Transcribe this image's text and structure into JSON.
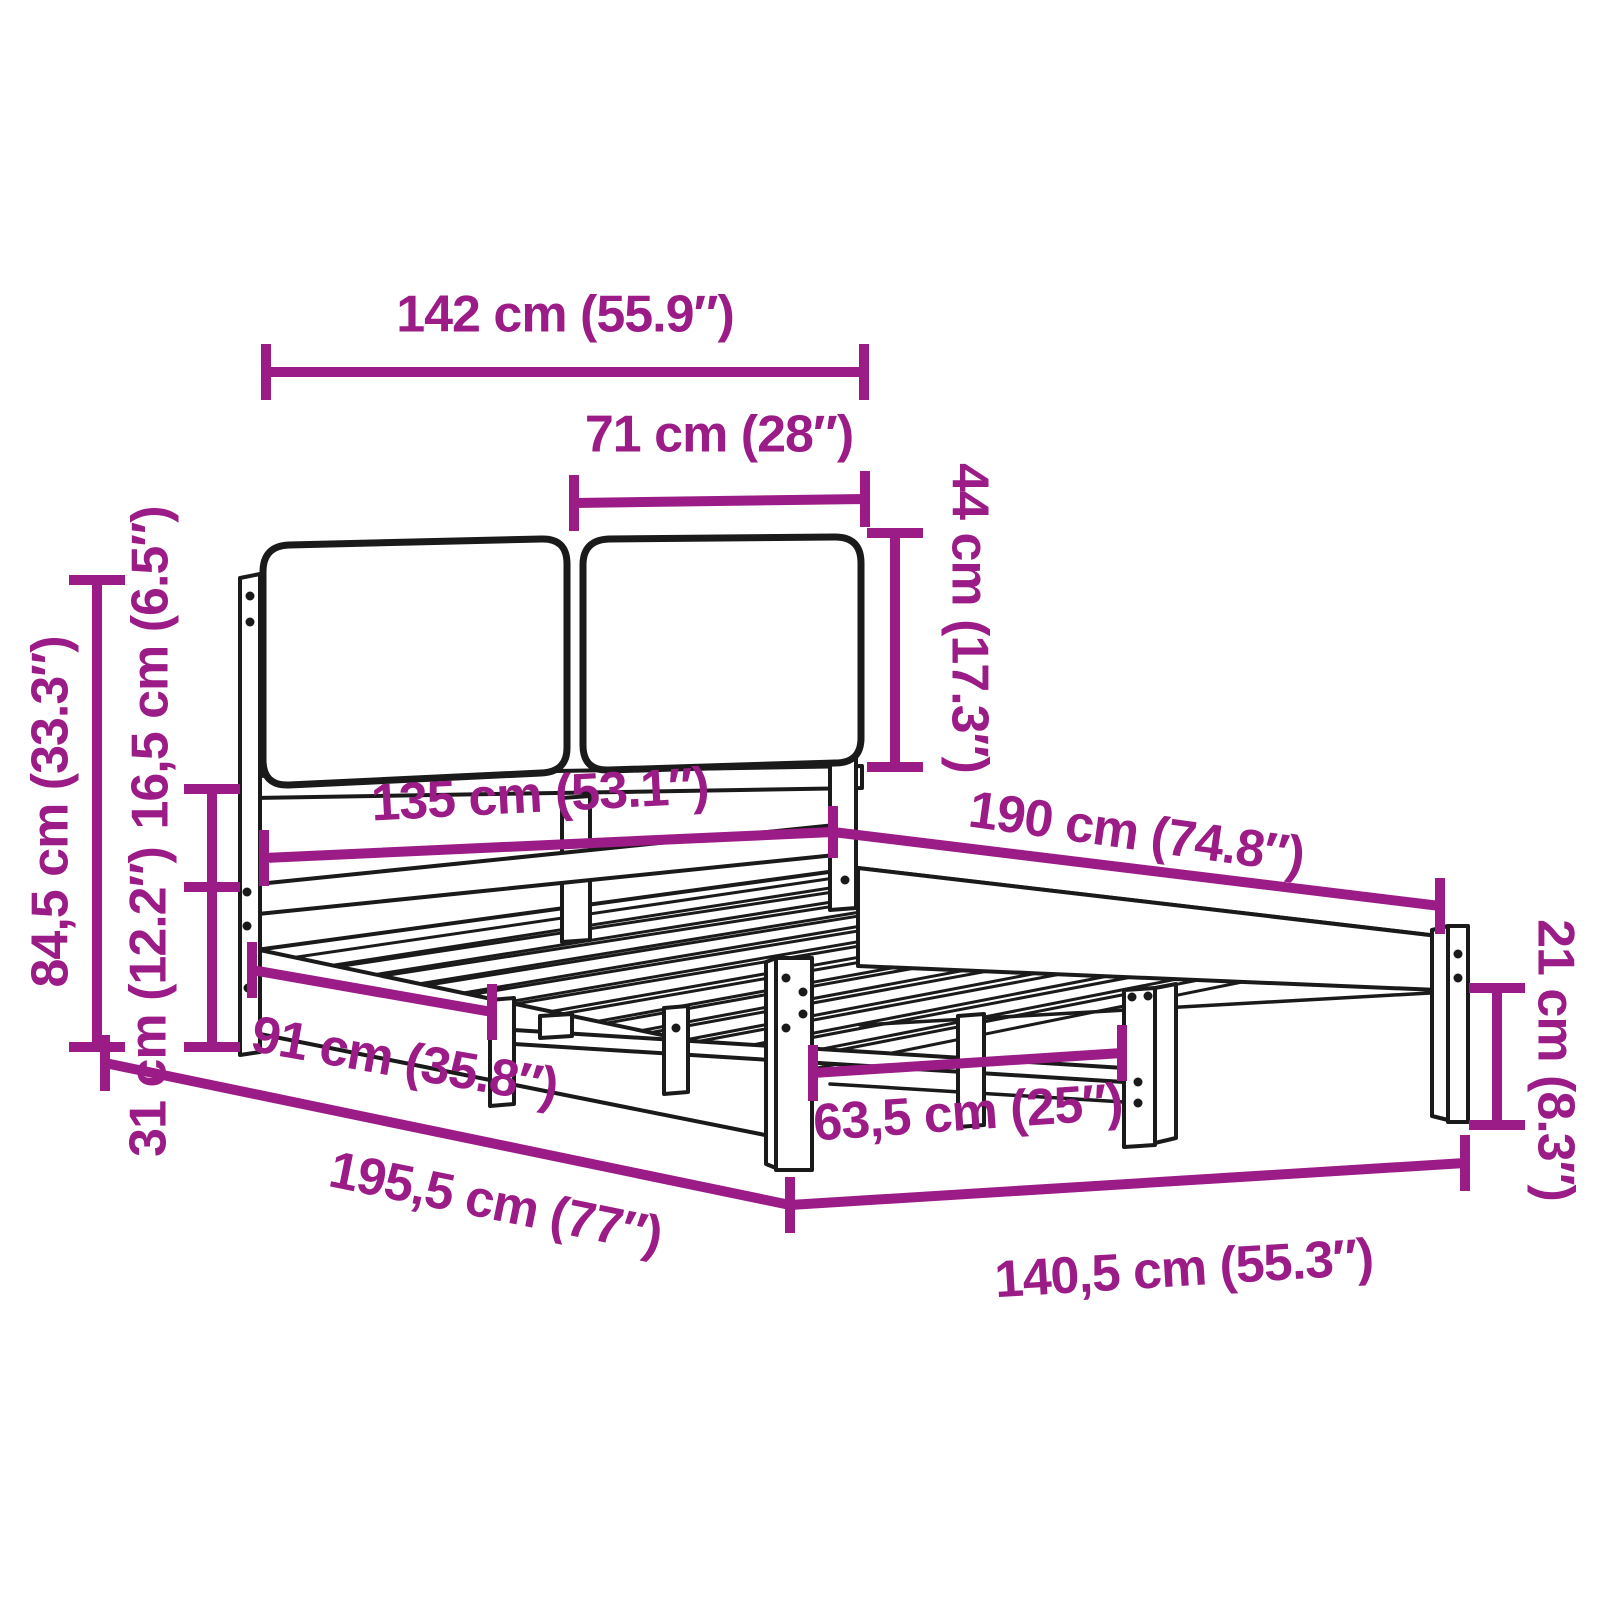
{
  "diagram": {
    "type": "product-dimension-diagram",
    "subject": "bed frame with two headboard cushions and slatted base",
    "view": "three-quarter perspective line drawing"
  },
  "colors": {
    "annotation": "#9B1B87",
    "outline": "#1a1a1a",
    "background": "#ffffff"
  },
  "dimensions": {
    "headboard_total_width": "142 cm (55.9″)",
    "cushion_width": "71 cm (28″)",
    "cushion_height": "44 cm (17.3″)",
    "headboard_height": "84,5 cm (33.3″)",
    "cushion_bottom_to_rail": "16,5 cm (6.5″)",
    "rail_to_floor_height": "31 cm (12.2″)",
    "inner_width": "135 cm (53.1″)",
    "inner_length": "190 cm (74.8″)",
    "post_to_center_leg": "91 cm (35.8″)",
    "total_length": "195,5 cm (77″)",
    "center_leg_spacing": "63,5 cm (25″)",
    "total_width": "140,5 cm (55.3″)",
    "leg_height": "21 cm (8.3″)"
  }
}
